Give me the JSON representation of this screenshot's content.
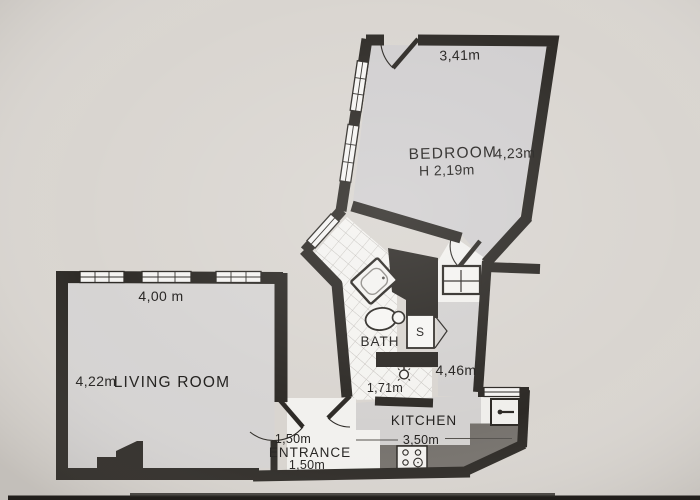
{
  "plan": {
    "type": "apartment-floor-plan",
    "rooms": {
      "bedroom": {
        "label": "BEDROOM",
        "top_dim": "3,41m",
        "width_dim": "4,23m",
        "height_note": "H 2,19m"
      },
      "living_room": {
        "label": "LIVING ROOM",
        "top_dim": "4,00 m",
        "side_dim": "4,22m"
      },
      "bath": {
        "label": "BATH",
        "length_dim": "1,71m"
      },
      "shaft": {
        "label": "S"
      },
      "kitchen": {
        "label": "KITCHEN",
        "side_dim": "4,46m",
        "bottom_dim": "3,50m"
      },
      "entrance": {
        "label": "ENTRANCE",
        "top_dim": "1,50m",
        "bottom_dim": "1,50m"
      }
    },
    "colors": {
      "background": "#d9d5d0",
      "wall": "#2d2a26",
      "room_floor": "#d3d1d0",
      "wet_floor": "#f4f3f0",
      "counter": "#76726d",
      "text": "#23211f",
      "photo_edge": "#211e1b"
    }
  }
}
